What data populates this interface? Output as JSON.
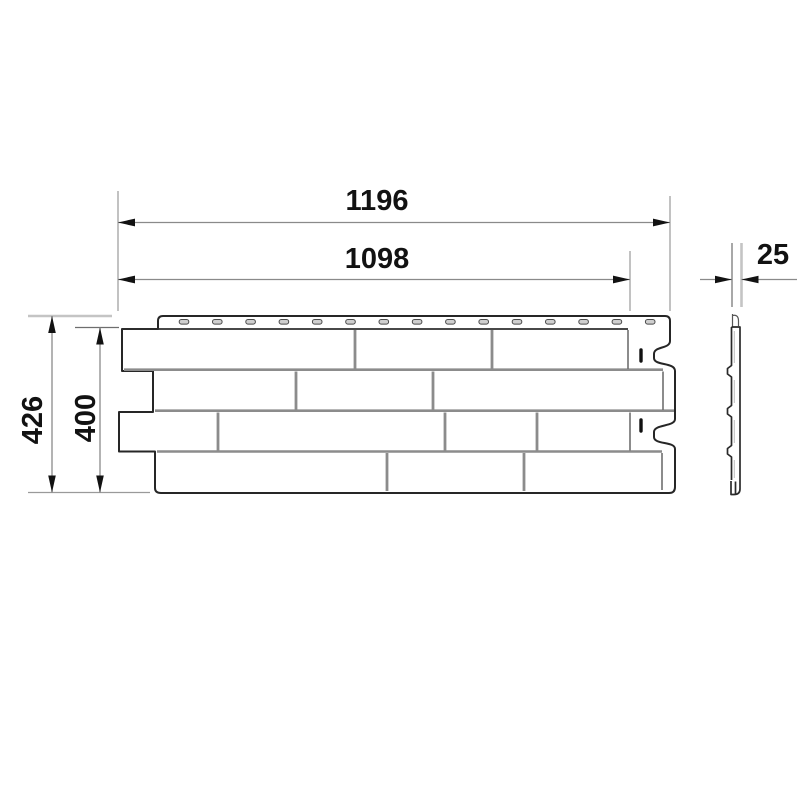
{
  "drawing": {
    "type": "technical dimension drawing",
    "subject": "facade panel — front view with brick pattern and side profile view",
    "dimensions": {
      "width_total": "1196",
      "width_nominal": "1098",
      "thickness": "25",
      "height_total": "426",
      "height_nominal": "400"
    },
    "panel": {
      "brick_rows": 4,
      "nail_slot_count": 15,
      "lock_dash_count": 2
    },
    "colors": {
      "background": "#ffffff",
      "outline": "#262626",
      "brick_joint": "#8c8c8c",
      "dimension_line": "#8a8a8a",
      "extension_line": "#9a9a9a",
      "edge_extension": "#c4c4c4",
      "arrow_and_text": "#121212",
      "slot_fill": "#cfcfcf"
    }
  }
}
